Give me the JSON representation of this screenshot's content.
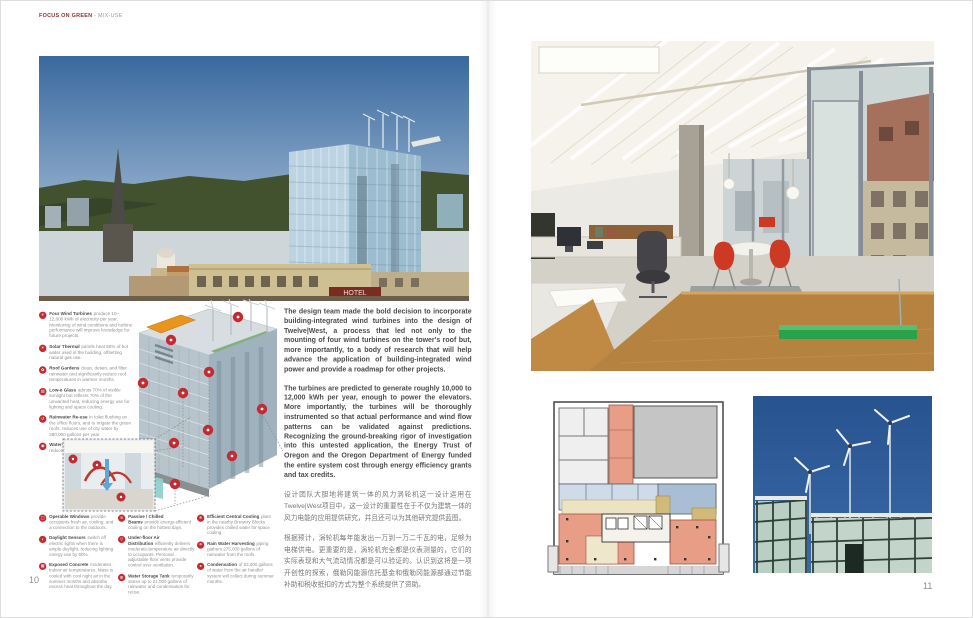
{
  "header": {
    "section": "FOCUS ON GREEN",
    "subsection": "- MIX-USE"
  },
  "accent_color": "#c42b31",
  "pages": {
    "left_number": "10",
    "right_number": "11"
  },
  "skyline_photo": {
    "hotel_sign": "HOTEL"
  },
  "features": [
    {
      "icon": "✳",
      "title": "Four Wind Turbines",
      "desc": "produce 10–12,000 kWh of electricity per year. Monitoring of wind conditions and turbine performance will improve knowledge for future projects."
    },
    {
      "icon": "☀",
      "title": "Solar Thermal",
      "desc": "panels heat 50% of hot water used in the building, offsetting natural gas use."
    },
    {
      "icon": "✿",
      "title": "Roof Gardens",
      "desc": "clean, detain, and filter rainwater and significantly reduce roof temperatures in warmer months."
    },
    {
      "icon": "▤",
      "title": "Low-e Glass",
      "desc": "admits 70% of visible sunlight but reflects 70% of the unwanted heat, reducing energy use for lighting and space cooling."
    },
    {
      "icon": "↺",
      "title": "Rainwater Re-use",
      "desc": "in toilet flushing on the office floors, and to irrigate the green roofs, reduces use of city water by 280,000 gallons per year."
    },
    {
      "icon": "◉",
      "title": "Water-efficient Plumbing Fixtures",
      "desc": "help reduce water use by more than 40%."
    }
  ],
  "legend": {
    "col1": [
      {
        "icon": "▢",
        "title": "Operable Windows",
        "desc": "provide occupants fresh air, cooling, and a connection to the outdoors."
      },
      {
        "icon": "◐",
        "title": "Daylight Sensors",
        "desc": "switch off electric lights when there is ample daylight, reducing lighting energy use by 60%."
      },
      {
        "icon": "▦",
        "title": "Exposed Concrete",
        "desc": "moderates indoor air temperatures. Mass is cooled with cool night air in the summer months and absorbs excess heat throughout the day."
      }
    ],
    "col2": [
      {
        "icon": "≋",
        "title": "Passive / Chilled Beams",
        "desc": "provide energy-efficient cooling on the hottest days."
      },
      {
        "icon": "▽",
        "title": "Under-floor Air Distribution",
        "desc": "efficiently delivers moderate-temperature air directly to occupants. Personal adjustable floor vents provide control over ventilation."
      },
      {
        "icon": "◍",
        "title": "Water Storage Tank",
        "desc": "temporarily stores up to 21,000 gallons of rainwater and condensation for reuse."
      }
    ],
    "col3": [
      {
        "icon": "❄",
        "title": "Efficient Central Cooling",
        "desc": "plant in the nearby Brewery Blocks provides chilled water for space cooling."
      },
      {
        "icon": "☂",
        "title": "Rain Water Harvesting",
        "desc": "piping gathers 275,000 gallons of rainwater from the roofs."
      },
      {
        "icon": "●",
        "title": "Condensation",
        "desc": "of 53,000 gallons of water from the air handler system will collect during summer months."
      }
    ]
  },
  "article": {
    "en_1": "The design team made the bold decision to incorporate building-integrated wind turbines into the design of Twelve|West, a process that led not only to the mounting of four wind turbines on the tower's roof but, more importantly, to a body of research that will help advance the application of building-integrated wind power and provide a roadmap for other projects.",
    "en_2": "The turbines are predicted to generate roughly 10,000 to 12,000 kWh per year, enough to power the elevators. More importantly, the turbines will be thoroughly instrumented so that actual performance and wind flow patterns can be validated against predictions. Recognizing the ground-breaking rigor of investigation into this untested application, the Energy Trust of Oregon and the Oregon Department of Energy funded the entire system cost through energy efficiency grants and tax credits.",
    "zh_1": "设计团队大胆地将建筑一体的风力涡轮机这一设计运用在Twelve|West项目中，这一设计的重要性在于不仅为建筑一体的风力电能的应用提供研究，并且还可以为其他研究提供蓝图。",
    "zh_2": "根据预计，涡轮机每年能发出一万到一万二千瓦的电，足够为电梯供电。更重要的是，涡轮机完全都是仪表测量的，它们的实际表现和大气流动情况都是可以验证的。认识到这将是一项开创性的探索，俄勒冈能源信托基金和俄勒冈能源部通过节能补助和税收抵扣的方式为整个系统提供了资助。"
  }
}
